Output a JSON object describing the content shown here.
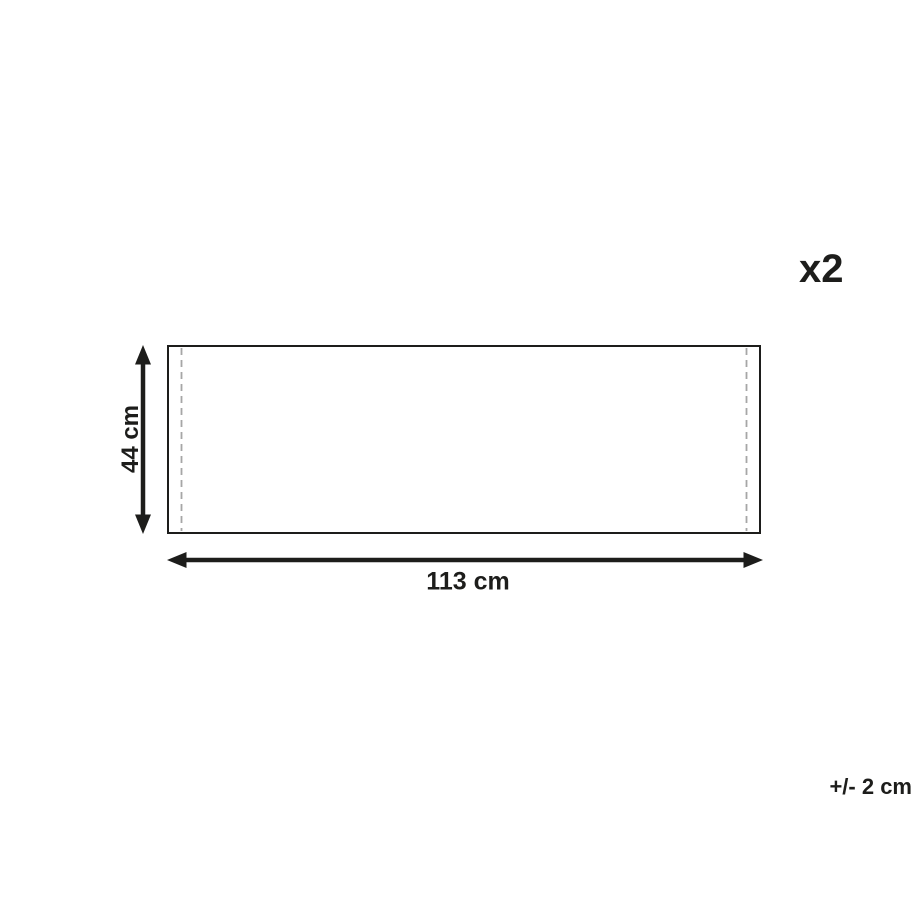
{
  "diagram": {
    "quantity_label": "x2",
    "tolerance_label": "+/- 2 cm",
    "height_dimension": {
      "label": "44 cm",
      "value": 44,
      "unit": "cm"
    },
    "width_dimension": {
      "label": "113 cm",
      "value": 113,
      "unit": "cm"
    },
    "colors": {
      "line": "#1d1d1b",
      "seam_dashed": "#a6a6a6",
      "background": "#ffffff",
      "text": "#1d1d1b"
    }
  }
}
